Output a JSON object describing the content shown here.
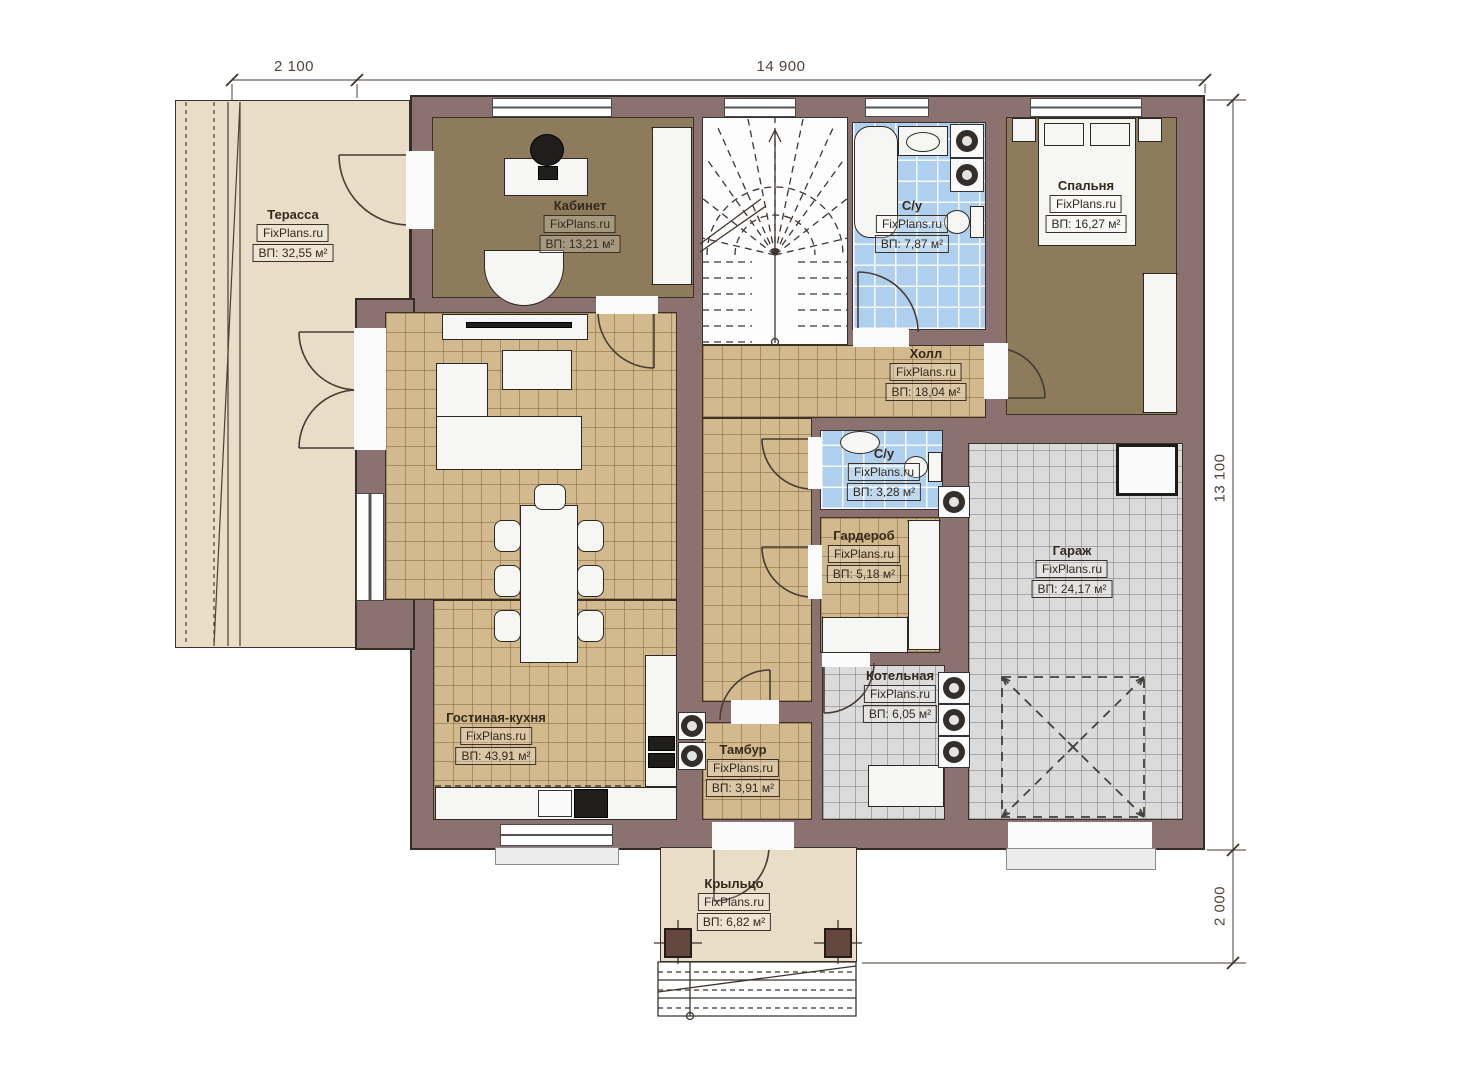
{
  "dimensions": {
    "terrace_width": "2 100",
    "house_width": "14 900",
    "house_depth": "13 100",
    "porch_depth": "2 000"
  },
  "rooms": [
    {
      "key": "terrace",
      "name": "Терасса",
      "brand": "FixPlans.ru",
      "area": "ВП: 32,55 м²"
    },
    {
      "key": "office",
      "name": "Кабинет",
      "brand": "FixPlans.ru",
      "area": "ВП: 13,21 м²"
    },
    {
      "key": "bathroom-1",
      "name": "С/у",
      "brand": "FixPlans.ru",
      "area": "ВП: 7,87 м²"
    },
    {
      "key": "bedroom",
      "name": "Спальня",
      "brand": "FixPlans.ru",
      "area": "ВП: 16,27 м²"
    },
    {
      "key": "hall",
      "name": "Холл",
      "brand": "FixPlans.ru",
      "area": "ВП: 18,04 м²"
    },
    {
      "key": "bathroom-2",
      "name": "С/у",
      "brand": "FixPlans.ru",
      "area": "ВП: 3,28 м²"
    },
    {
      "key": "wardrobe",
      "name": "Гардероб",
      "brand": "FixPlans.ru",
      "area": "ВП: 5,18 м²"
    },
    {
      "key": "garage",
      "name": "Гараж",
      "brand": "FixPlans.ru",
      "area": "ВП: 24,17 м²"
    },
    {
      "key": "boiler",
      "name": "Котельная",
      "brand": "FixPlans.ru",
      "area": "ВП: 6,05 м²"
    },
    {
      "key": "living-kitchen",
      "name": "Гостиная-кухня",
      "brand": "FixPlans.ru",
      "area": "ВП: 43,91 м²"
    },
    {
      "key": "vestibule",
      "name": "Тамбур",
      "brand": "FixPlans.ru",
      "area": "ВП: 3,91 м²"
    },
    {
      "key": "porch",
      "name": "Крыльцо",
      "brand": "FixPlans.ru",
      "area": "ВП: 6,82 м²"
    }
  ]
}
